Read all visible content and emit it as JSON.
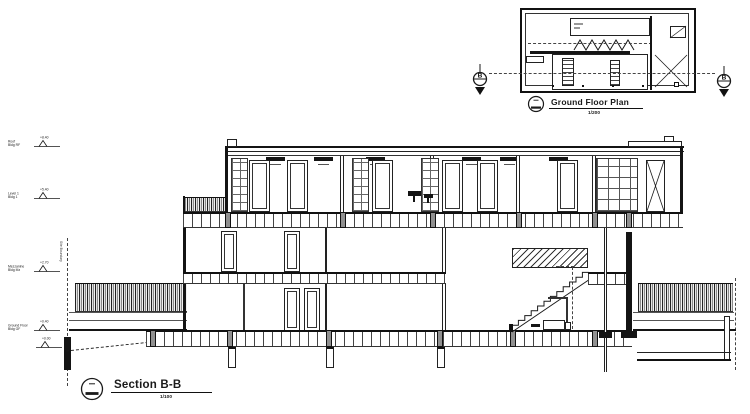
{
  "sheet": {
    "plan": {
      "title": "Ground Floor Plan",
      "scale": "1/200",
      "marker_left": "B",
      "marker_right": "B"
    },
    "section": {
      "title": "Section B-B",
      "scale": "1/100"
    },
    "levels": [
      {
        "label": "Roof",
        "sublabel": "Bldg RF",
        "elevation": "+8.40"
      },
      {
        "label": "Level 1",
        "sublabel": "Bldg 1",
        "elevation": "+5.40"
      },
      {
        "label": "Mezzanine",
        "sublabel": "Bldg Mz",
        "elevation": "+2.70"
      },
      {
        "label": "Ground Floor",
        "sublabel": "Bldg GF",
        "elevation": "+0.40"
      },
      {
        "label": "",
        "sublabel": "",
        "elevation": "+0.00"
      }
    ],
    "site": {
      "boundary_label": "Site Boundary"
    },
    "colors": {
      "line": "#1a1a1a",
      "grey_fill": "#909090",
      "background": "#ffffff"
    }
  }
}
